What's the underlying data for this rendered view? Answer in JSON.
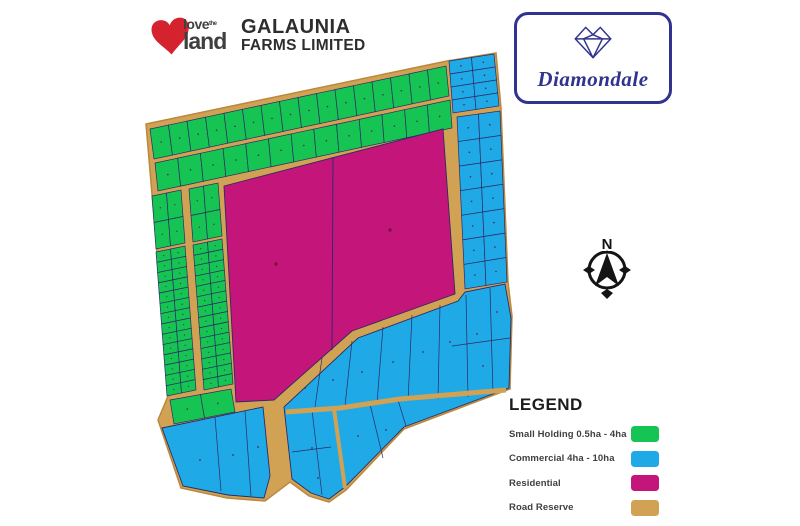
{
  "header": {
    "logo": {
      "love": "love",
      "the": "the",
      "land": "land"
    },
    "company": {
      "line1": "GALAUNIA",
      "line2": "FARMS LIMITED"
    }
  },
  "badge": {
    "title": "Diamondale"
  },
  "compass": {
    "north_label": "N"
  },
  "legend": {
    "title": "LEGEND",
    "items": [
      {
        "key": "small_holding",
        "label": "Small Holding  0.5ha - 4ha",
        "color": "#16c453"
      },
      {
        "key": "commercial",
        "label": "Commercial 4ha - 10ha",
        "color": "#1fa9e6"
      },
      {
        "key": "residential",
        "label": "Residential",
        "color": "#c4157a"
      },
      {
        "key": "road_reserve",
        "label": "Road Reserve",
        "color": "#d2a254"
      }
    ]
  },
  "map": {
    "plot_line_color": "#2c2a66",
    "plot_label_color": "#47243f",
    "residential_label_color": "#6b1030",
    "road_edge_color": "#b8893f",
    "brand_heart_color": "#d4232e",
    "badge_navy_color": "#31338e"
  }
}
